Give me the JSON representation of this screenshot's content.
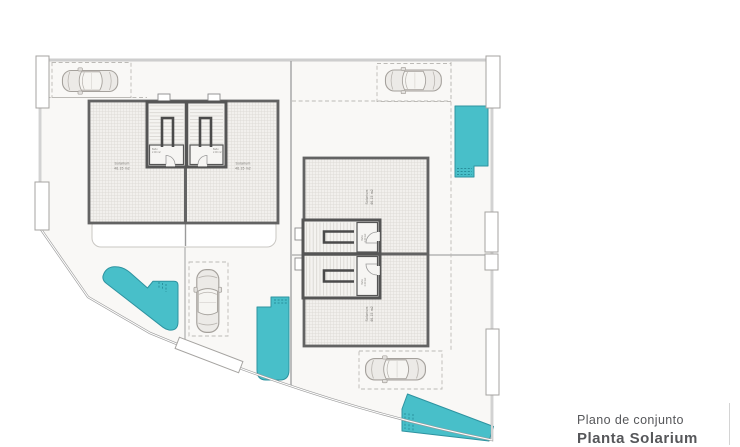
{
  "title_block": {
    "line1": "Plano de conjunto",
    "line2": "Planta Solarium"
  },
  "rooms": {
    "left_a": {
      "name": "Solarium",
      "area": "46.15 m2"
    },
    "left_b": {
      "name": "Solarium",
      "area": "46.15 m2"
    },
    "right_a": {
      "name": "Solarium",
      "area": "46.15 m2"
    },
    "right_b": {
      "name": "Solarium",
      "area": "46.15 m2"
    }
  },
  "stair_room": {
    "name": "Baño",
    "area": "2.00 m2"
  },
  "colors": {
    "pool": "#48bfc9",
    "pool_edge": "#2e93a0",
    "wall": "#636363",
    "boundary": "#9c9c9c",
    "title_text": "#56575a"
  }
}
